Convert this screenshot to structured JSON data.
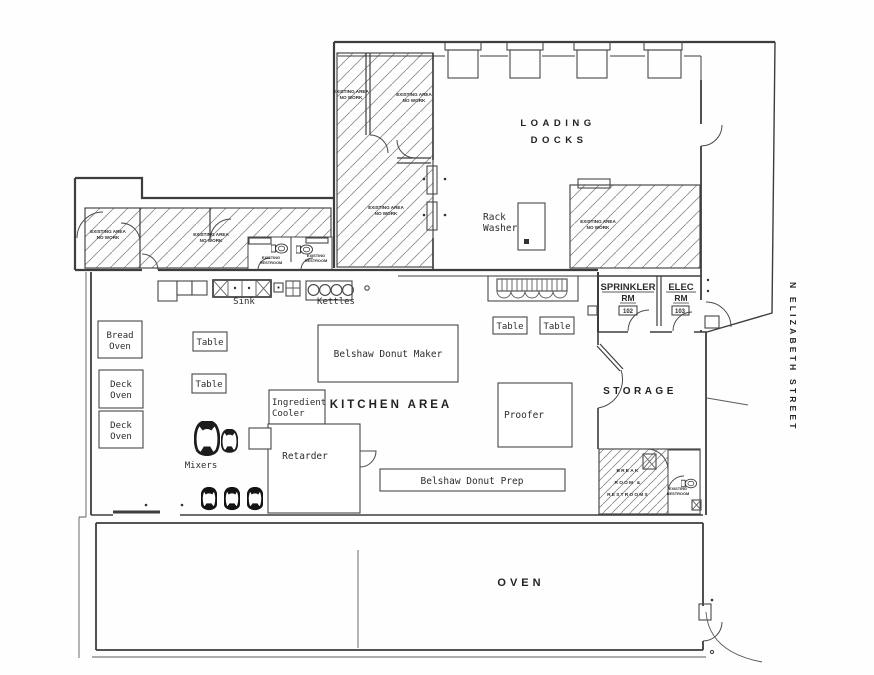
{
  "colors": {
    "ink": "#3d3d3d",
    "paper": "#fefefe",
    "hatch": "#8f8f8f"
  },
  "street": {
    "label": "N ELIZABETH STREET"
  },
  "rooms": {
    "loading_docks_line1": "LOADING",
    "loading_docks_line2": "DOCKS",
    "kitchen_area": "KITCHEN AREA",
    "storage": "STORAGE",
    "oven": "OVEN",
    "sprinkler_name": "SPRINKLER",
    "sprinkler_rm": "RM",
    "sprinkler_number": "102",
    "elec_name": "ELEC",
    "elec_rm": "RM",
    "elec_number": "103",
    "break_line1": "BREAK",
    "break_line2": "ROOM &",
    "break_line3": "RESTROOMS"
  },
  "equipment": {
    "rack_washer_line1": "Rack",
    "rack_washer_line2": "Washer",
    "bread_oven_line1": "Bread",
    "bread_oven_line2": "Oven",
    "deck_oven_line1": "Deck",
    "deck_oven_line2": "Oven",
    "table": "Table",
    "mixers": "Mixers",
    "sink": "Sink",
    "kettles": "Kettles",
    "belshaw_donut_maker": "Belshaw Donut Maker",
    "belshaw_donut_prep": "Belshaw Donut Prep",
    "ingredient_cooler_line1": "Ingredient",
    "ingredient_cooler_line2": "Cooler",
    "retarder": "Retarder",
    "proofer": "Proofer"
  },
  "annotations": {
    "existing_area_line1": "EXISTING AREA",
    "existing_area_line2": "NO WORK",
    "existing_restroom_line1": "EXISTING",
    "existing_restroom_line2": "RESTROOM"
  }
}
